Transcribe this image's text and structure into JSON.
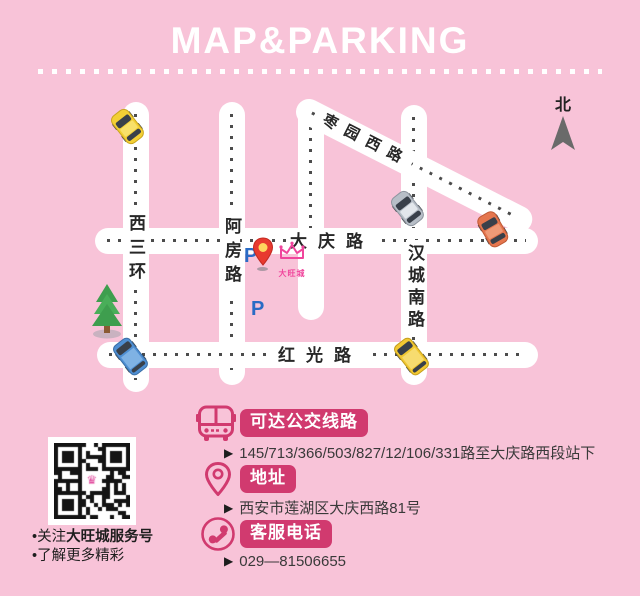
{
  "title": "MAP&PARKING",
  "map": {
    "north_label": "北",
    "roads": {
      "xisanhuan": "西三环",
      "afanglu": "阿房路",
      "daqinglu": "大庆路",
      "hanchengnanlu": "汉城南路",
      "hongguanglu": "红光路",
      "zaoyuanxilu": "枣园西路"
    },
    "parking_p_north": "P",
    "parking_p_south": "P",
    "venue_name": "大旺城"
  },
  "info": {
    "bus": {
      "badge": "可达公交线路",
      "marker": "▶",
      "detail": "145/713/366/503/827/12/106/331路至大庆路西段站下"
    },
    "address": {
      "badge": "地址",
      "marker": "▶",
      "detail": "西安市莲湖区大庆西路81号"
    },
    "phone": {
      "badge": "客服电话",
      "marker": "▶",
      "detail": "029—81506655"
    }
  },
  "qr": {
    "caption1_prefix": "•关注",
    "caption1_bold": "大旺城服务号",
    "caption2": "•了解更多精彩"
  },
  "colors": {
    "background": "#f8c3d8",
    "accent": "#d13a6f",
    "logo_pink": "#f0459c",
    "parking_blue": "#2a6bc5",
    "pin_red": "#e8392f",
    "road_white": "#ffffff",
    "dash_gray": "#4c4c4c"
  }
}
